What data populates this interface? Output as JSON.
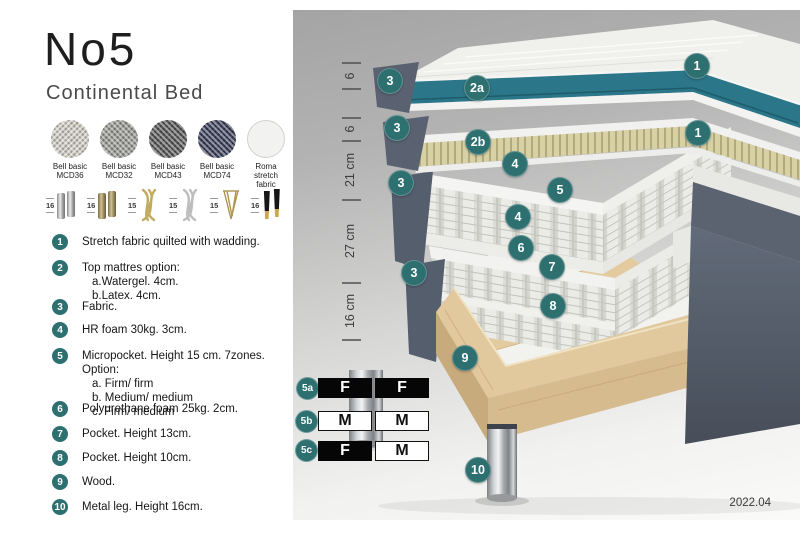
{
  "title": "No5",
  "subtitle": "Continental Bed",
  "fabrics": [
    {
      "line1": "Bell basic",
      "line2": "MCD36",
      "color": "#d6d2c8"
    },
    {
      "line1": "Bell basic",
      "line2": "MCD32",
      "color": "#9d9d99"
    },
    {
      "line1": "Bell basic",
      "line2": "MCD43",
      "color": "#585a58"
    },
    {
      "line1": "Bell basic",
      "line2": "MCD74",
      "color": "#3c415c"
    },
    {
      "line1": "Roma",
      "line2": "stretch fabric",
      "color": "#f2f2f1"
    }
  ],
  "legs": [
    {
      "size": "16",
      "style": "chrome-cylinder-pair"
    },
    {
      "size": "16",
      "style": "brass-cylinder-pair"
    },
    {
      "size": "15",
      "style": "gold-twisted"
    },
    {
      "size": "15",
      "style": "silver-twisted"
    },
    {
      "size": "15",
      "style": "gold-hairpin"
    },
    {
      "size": "16",
      "style": "black-gold-tip-pair"
    }
  ],
  "legend": {
    "items": [
      {
        "num": "1",
        "lines": [
          "Stretch fabric quilted with wadding."
        ]
      },
      {
        "num": "2",
        "lines": [
          "Top mattres option:",
          "a.Watergel. 4cm.",
          "b.Latex. 4cm."
        ]
      },
      {
        "num": "3",
        "lines": [
          "Fabric."
        ]
      },
      {
        "num": "4",
        "lines": [
          "HR foam 30kg. 3cm."
        ]
      },
      {
        "num": "5",
        "lines": [
          "Micropocket. Height 15 cm. 7zones. Option:",
          "a. Firm/ firm",
          "b. Medium/ medium",
          "c. Firm/ medium"
        ]
      },
      {
        "num": "6",
        "lines": [
          "Polyurethane foam 25kg. 2cm."
        ]
      },
      {
        "num": "7",
        "lines": [
          "Pocket. Height 13cm."
        ]
      },
      {
        "num": "8",
        "lines": [
          "Pocket. Height 10cm."
        ]
      },
      {
        "num": "9",
        "lines": [
          "Wood."
        ]
      },
      {
        "num": "10",
        "lines": [
          "Metal leg. Height 16cm."
        ]
      }
    ]
  },
  "diagram": {
    "ruler": [
      "6",
      "6",
      "21 cm",
      "27 cm",
      "16 cm"
    ],
    "badges": [
      "3",
      "2a",
      "1",
      "3",
      "2b",
      "1",
      "4",
      "5",
      "4",
      "3",
      "6",
      "7",
      "3",
      "8",
      "9",
      "10"
    ],
    "firmness_table": [
      {
        "id": "5a",
        "cells": [
          {
            "text": "F",
            "bg": "black"
          },
          {
            "text": "F",
            "bg": "black"
          }
        ]
      },
      {
        "id": "5b",
        "cells": [
          {
            "text": "M",
            "bg": "white"
          },
          {
            "text": "M",
            "bg": "white"
          }
        ]
      },
      {
        "id": "5c",
        "cells": [
          {
            "text": "F",
            "bg": "black"
          },
          {
            "text": "M",
            "bg": "white"
          }
        ]
      }
    ],
    "version": "2022.04",
    "colors": {
      "badge_teal": "#2e6f70",
      "watergel_teal": "#2b7689",
      "latex_beige": "#d8d1a6",
      "outer_fabric": "#59606e",
      "wood": "#e1c89d"
    }
  }
}
